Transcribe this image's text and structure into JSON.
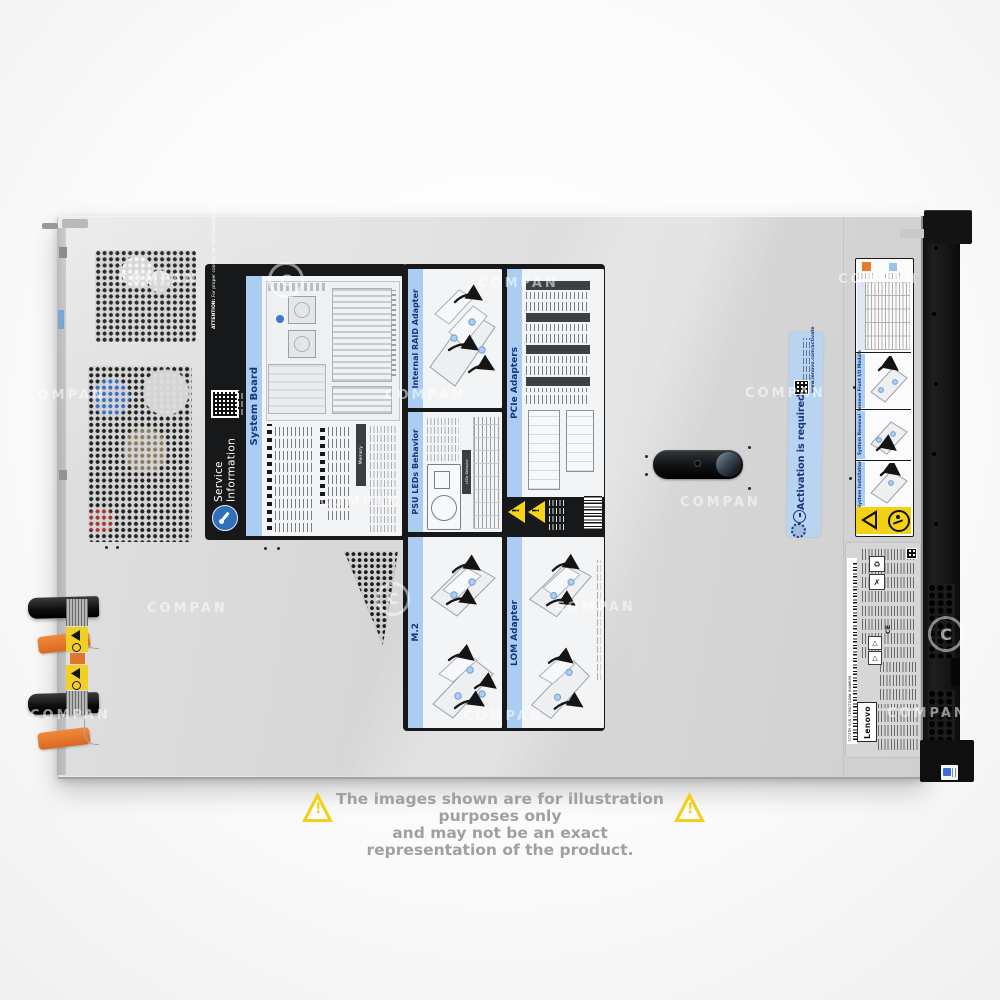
{
  "watermark": {
    "text": "COMPAN",
    "logo": "C"
  },
  "disclaimer": {
    "line1": "The images shown are for illustration purposes only",
    "line2": "and may not be an exact representation of the product."
  },
  "service_label": {
    "title_line1": "Service",
    "title_line2": "Information",
    "attention_title": "ATTENTION:",
    "attention_body": "For proper cooling, do not leave top cover off for more than 2 minutes at a time while the system is running.",
    "panels": {
      "system_board": "System Board",
      "memory": "Memory",
      "internal_raid": "Internal RAID Adapter",
      "pcie": "PCIe Adapters",
      "psu_leds": "PSU LEDs Behavior",
      "psu_leds_sub": "LEDs Behavior",
      "m2": "M.2",
      "lom": "LOM Adapter"
    }
  },
  "activation_sticker": {
    "title": "Activation is required",
    "url": "www.lenovo.com/activate"
  },
  "handling_label": {
    "section1": "Remove Front I/O Module",
    "section2": "System Removal",
    "section3": "System Installation"
  },
  "regulatory_label": {
    "brand": "Lenovo",
    "ce": "CE",
    "serial": "7Z73TM S/N 7Z00CTO1WW B44W698"
  },
  "icons": {
    "exclamation": "!",
    "recycle": "♻",
    "cross": "✗",
    "triangle": "△"
  }
}
